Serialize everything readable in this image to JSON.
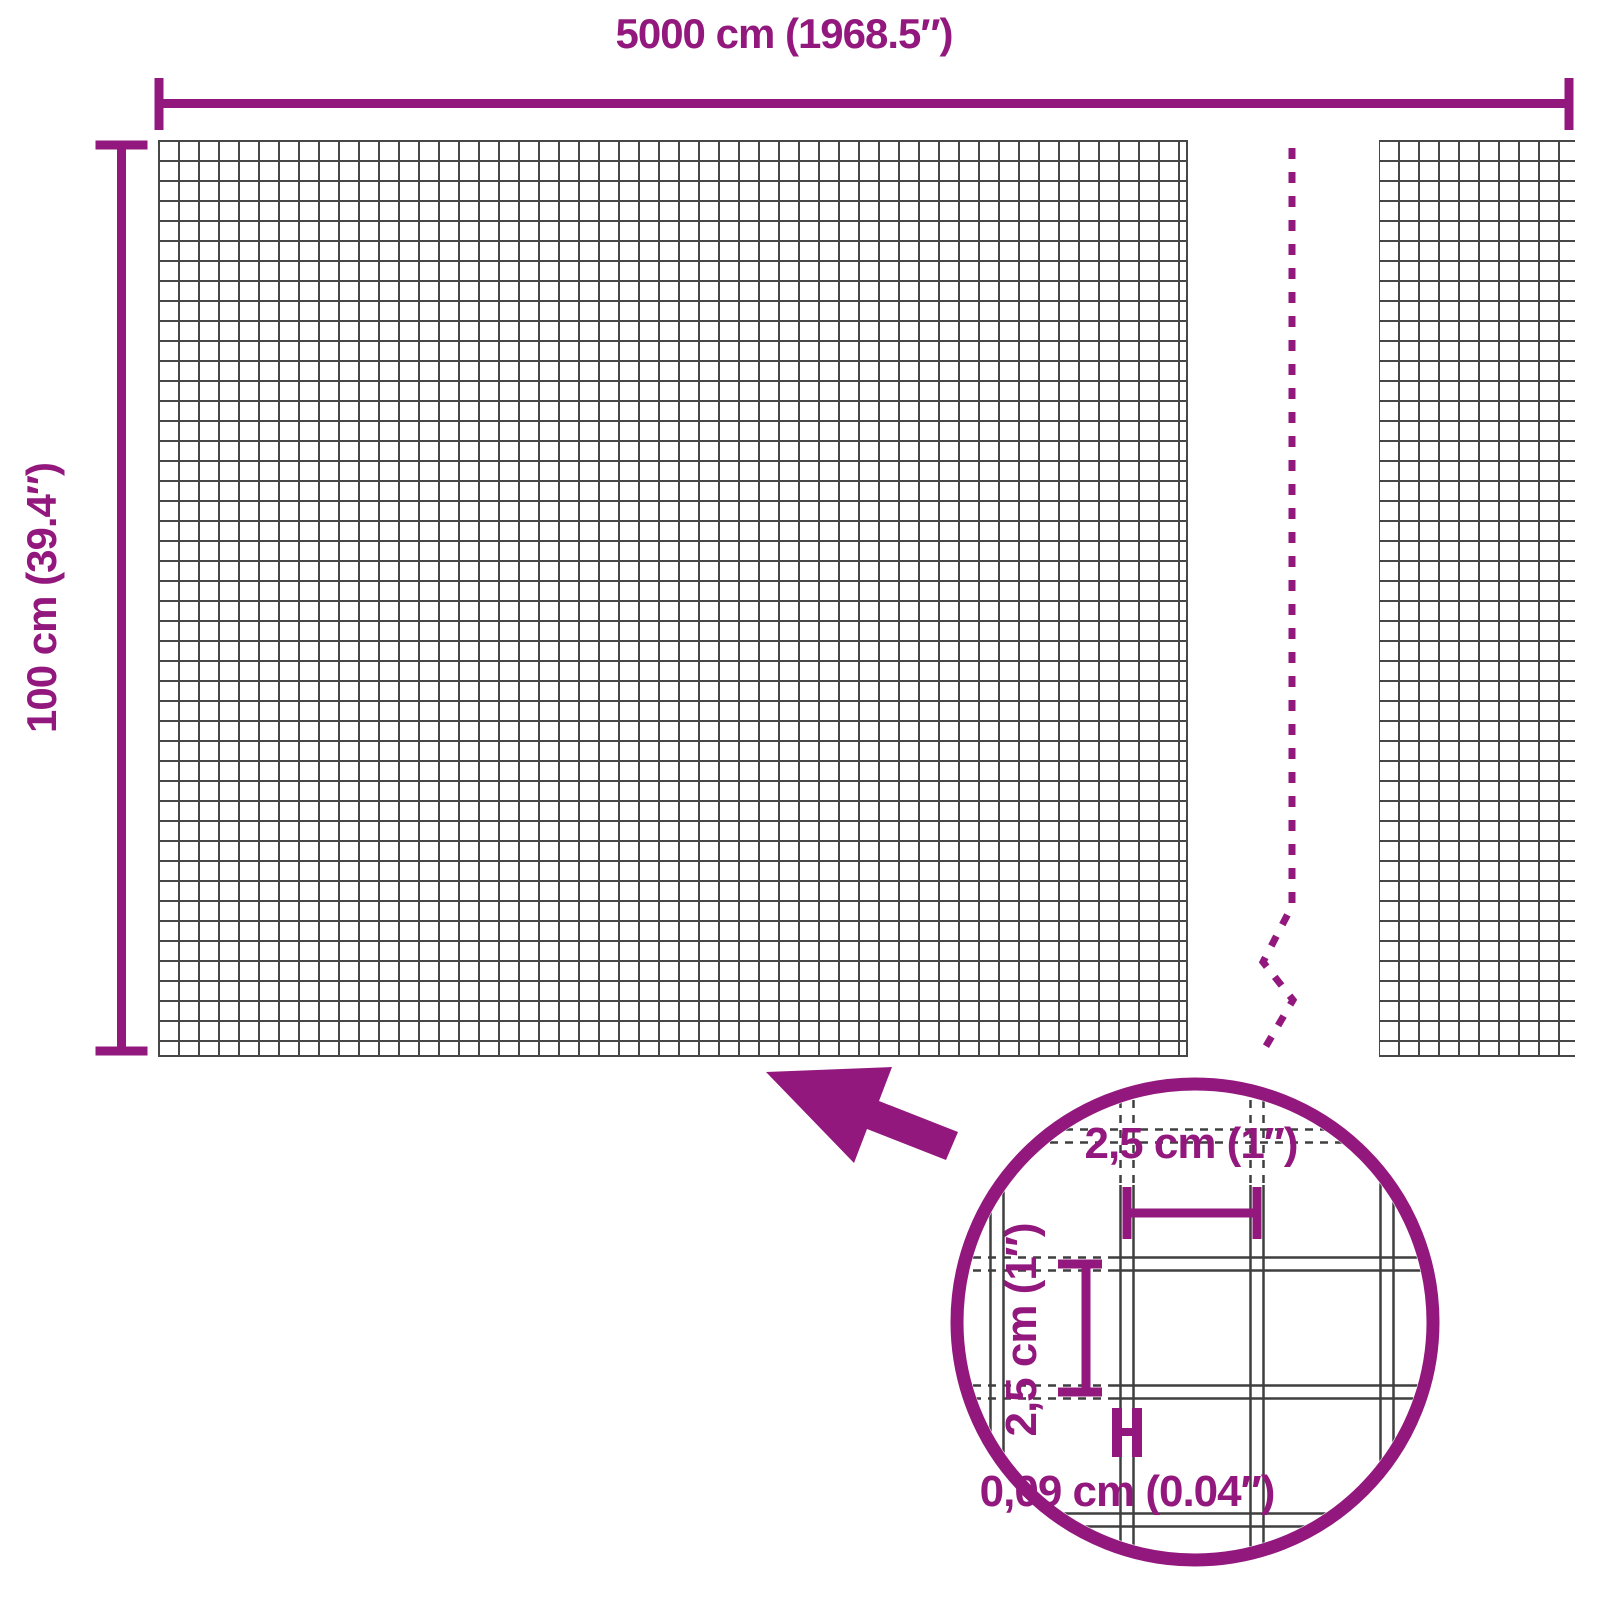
{
  "diagram": {
    "title": "wire-mesh-roll-dimension-diagram",
    "length_label": "5000 cm (1968.5″)",
    "height_label": "100 cm (39.4″)",
    "lens": {
      "mesh_width_label": "2,5 cm (1″)",
      "mesh_height_label": "2,5 cm (1″)",
      "wire_thickness_label": "0,09 cm (0.04″)"
    },
    "colors": {
      "accent": "#93187E",
      "mesh_line": "#474747",
      "background": "#FFFFFF"
    }
  }
}
